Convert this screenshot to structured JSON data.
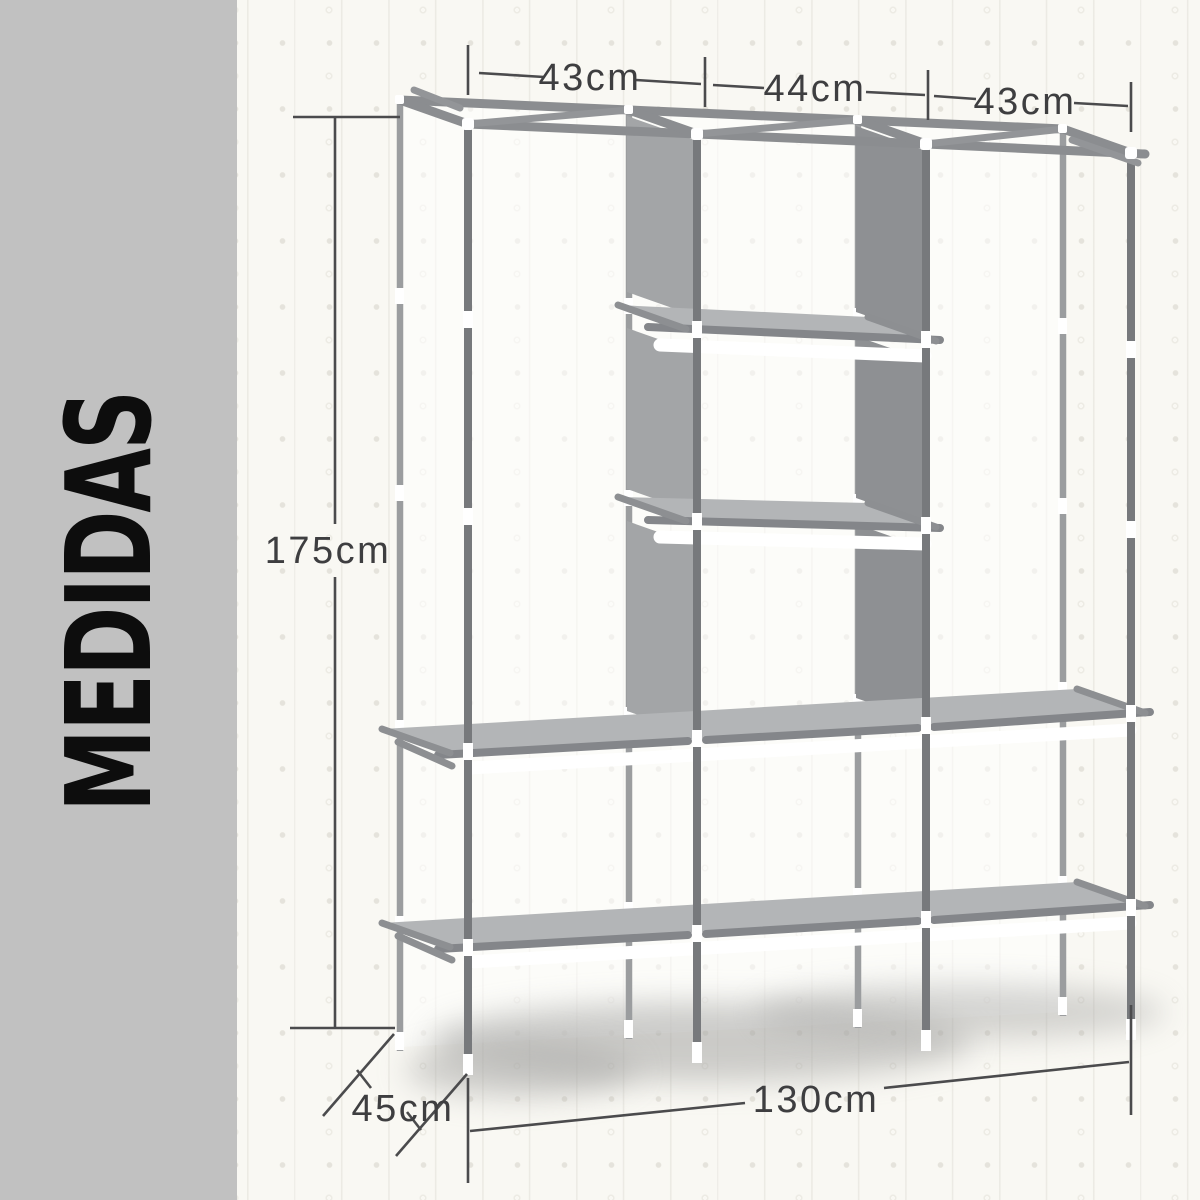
{
  "sidebar": {
    "label": "MEDIDAS",
    "bg": "#c1c1c1",
    "text_color": "#0d0d0d"
  },
  "measurements": {
    "top_left": "43cm",
    "top_middle": "44cm",
    "top_right": "43cm",
    "height": "175cm",
    "depth": "45cm",
    "width": "130cm"
  },
  "colors": {
    "wall_background": "#f9f8f3",
    "wall_pattern": "#e9e7e0",
    "dimension_line": "#4b4b4d",
    "dimension_text": "#3e3e40",
    "frame_tube": "#8b8d90",
    "pole_front": "#77797c",
    "pole_back": "#9b9d9f",
    "panel_left": "#a3a5a7",
    "panel_right": "#8e9093",
    "shelf_surface": "#b3b5b7",
    "shadow": "#a6a6a4"
  }
}
